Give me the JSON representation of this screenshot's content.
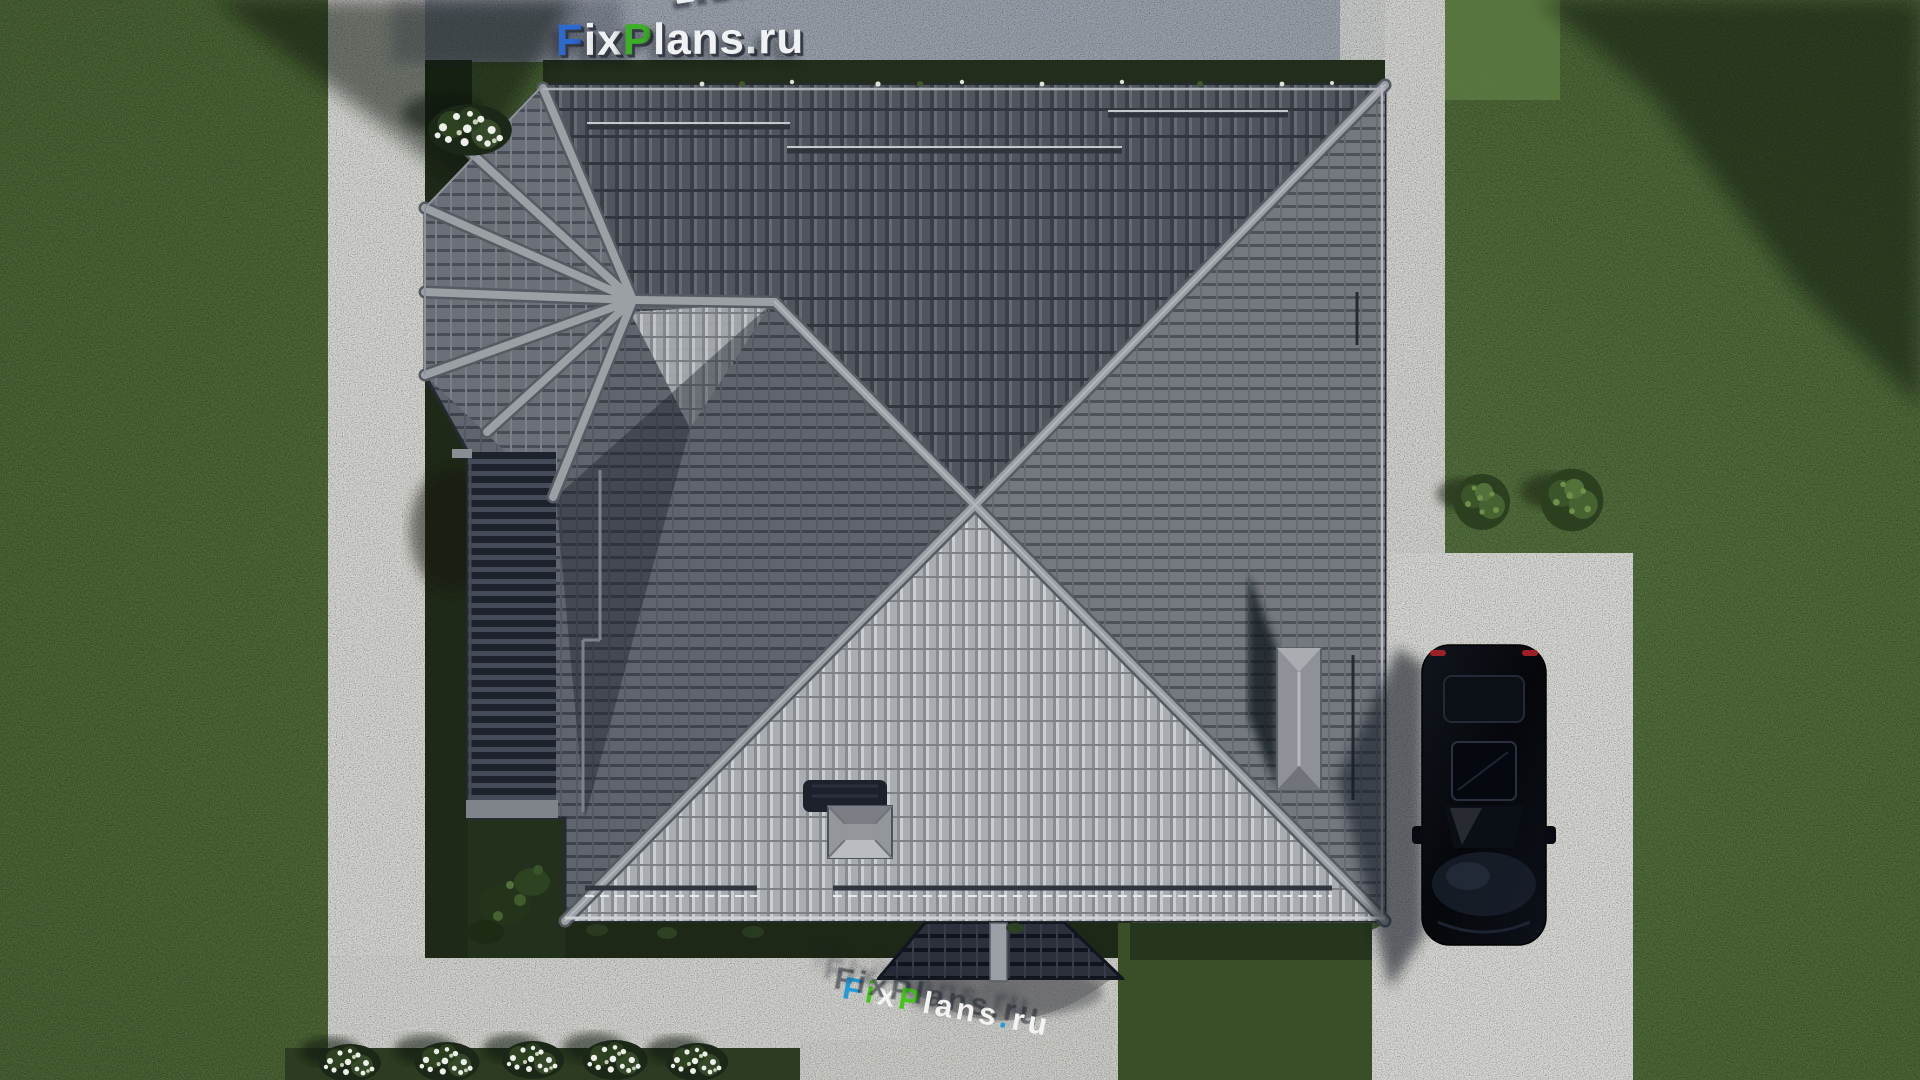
{
  "scene": {
    "type": "aerial-3d-render",
    "subject_counts": {
      "cars": 1,
      "flower_bushes_bottom": 5,
      "green_bushes_right": 2
    }
  },
  "watermark": {
    "brand": "FixPlans.ru",
    "seg": {
      "f": "F",
      "i": "i",
      "x": "x",
      "p": "P",
      "lans": "lans",
      "dot": ".",
      "ru": "ru"
    },
    "colors": {
      "blue": "#2b6ad1",
      "green": "#3fae27",
      "white": "#f0f2f4"
    }
  },
  "palette": {
    "grass": "#4d6837",
    "grass_shaded": "#232d1b",
    "concrete": "#d5d5d1",
    "concrete_shaded": "#9aa0ab",
    "roof_north": "#50555d",
    "roof_east": "#75797f",
    "roof_south": "#a9adb2",
    "roof_west": "#60656d",
    "roof_dark_wing": "#20252f",
    "ridge": "#9ba0a5",
    "porch_roof": "#2b303b",
    "car_body": "#0a0d13",
    "car_taillight": "#9c2026"
  }
}
